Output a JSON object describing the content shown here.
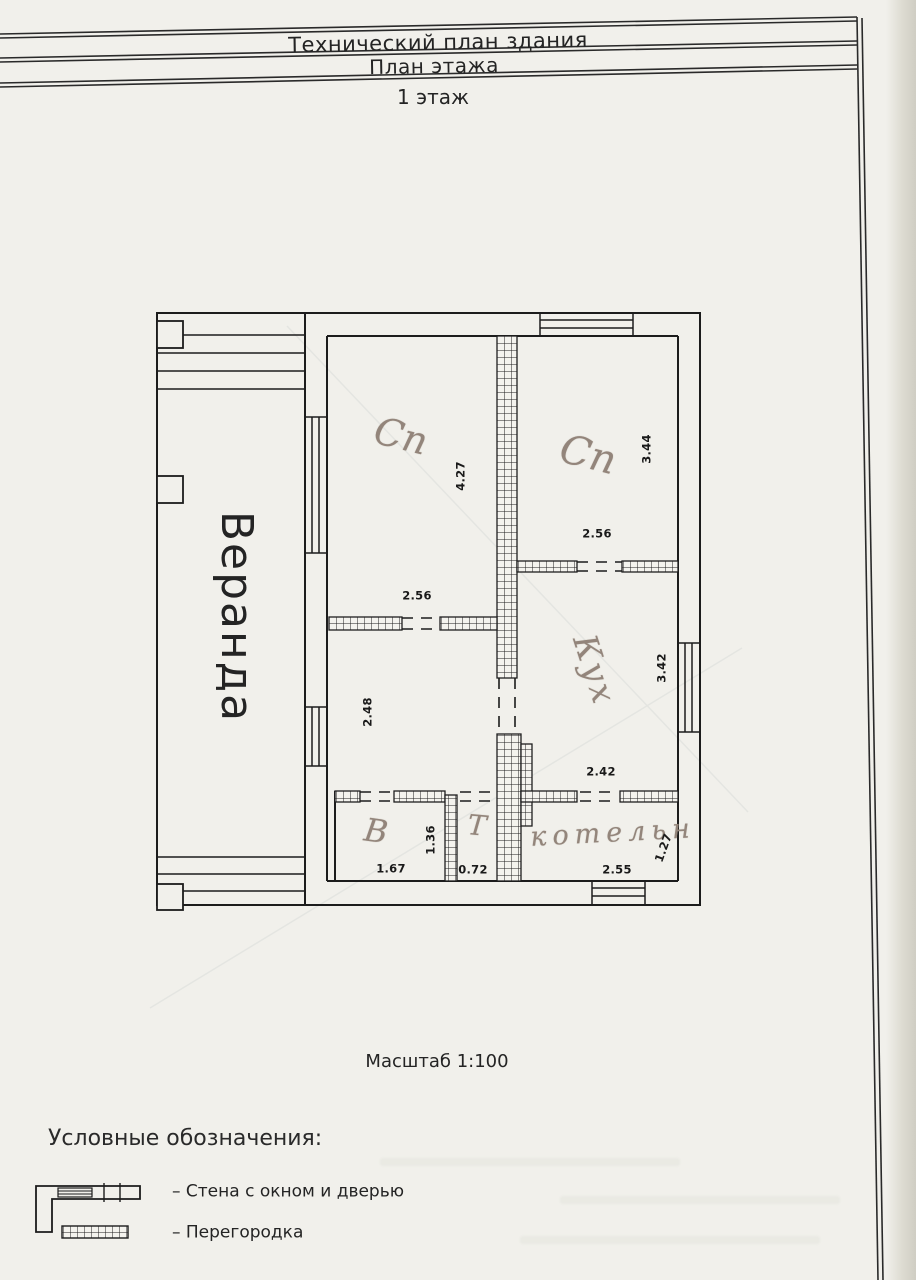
{
  "header": {
    "title": "Технический план здания",
    "subtitle": "План этажа",
    "floor_label": "1 этаж"
  },
  "plan": {
    "scale_label": "Масштаб 1:100",
    "rooms": [
      {
        "label": "Веранда",
        "type": "printed-vertical"
      },
      {
        "label": "Сп",
        "type": "handwritten"
      },
      {
        "label": "Сп",
        "type": "handwritten"
      },
      {
        "label": "Кух",
        "type": "handwritten"
      },
      {
        "label": "В",
        "type": "handwritten"
      },
      {
        "label": "Т",
        "type": "handwritten"
      },
      {
        "label": "котельн",
        "type": "handwritten"
      }
    ],
    "dimensions": [
      {
        "value": "4.27",
        "room": "bedroom-1",
        "orientation": "vertical"
      },
      {
        "value": "2.56",
        "room": "bedroom-1",
        "orientation": "horizontal"
      },
      {
        "value": "3.44",
        "room": "bedroom-2",
        "orientation": "vertical"
      },
      {
        "value": "2.56",
        "room": "bedroom-2",
        "orientation": "horizontal"
      },
      {
        "value": "2.48",
        "room": "middle-room",
        "orientation": "vertical"
      },
      {
        "value": "3.42",
        "room": "kitchen",
        "orientation": "vertical"
      },
      {
        "value": "2.42",
        "room": "kitchen",
        "orientation": "horizontal"
      },
      {
        "value": "1.67",
        "room": "bathroom",
        "orientation": "horizontal"
      },
      {
        "value": "1.36",
        "room": "bathroom",
        "orientation": "vertical"
      },
      {
        "value": "0.72",
        "room": "toilet",
        "orientation": "horizontal"
      },
      {
        "value": "2.55",
        "room": "boiler-room",
        "orientation": "horizontal"
      },
      {
        "value": "1.27",
        "room": "boiler-room",
        "orientation": "vertical"
      }
    ]
  },
  "legend": {
    "heading": "Условные обозначения:",
    "items": [
      {
        "symbol": "wall-with-window-and-door",
        "label": "– Стена с окном и дверью"
      },
      {
        "symbol": "partition",
        "label": "– Перегородка"
      }
    ]
  },
  "colors": {
    "ink": "#1c1c1c",
    "pencil": "#93857b",
    "paper": "#f1f0eb"
  }
}
